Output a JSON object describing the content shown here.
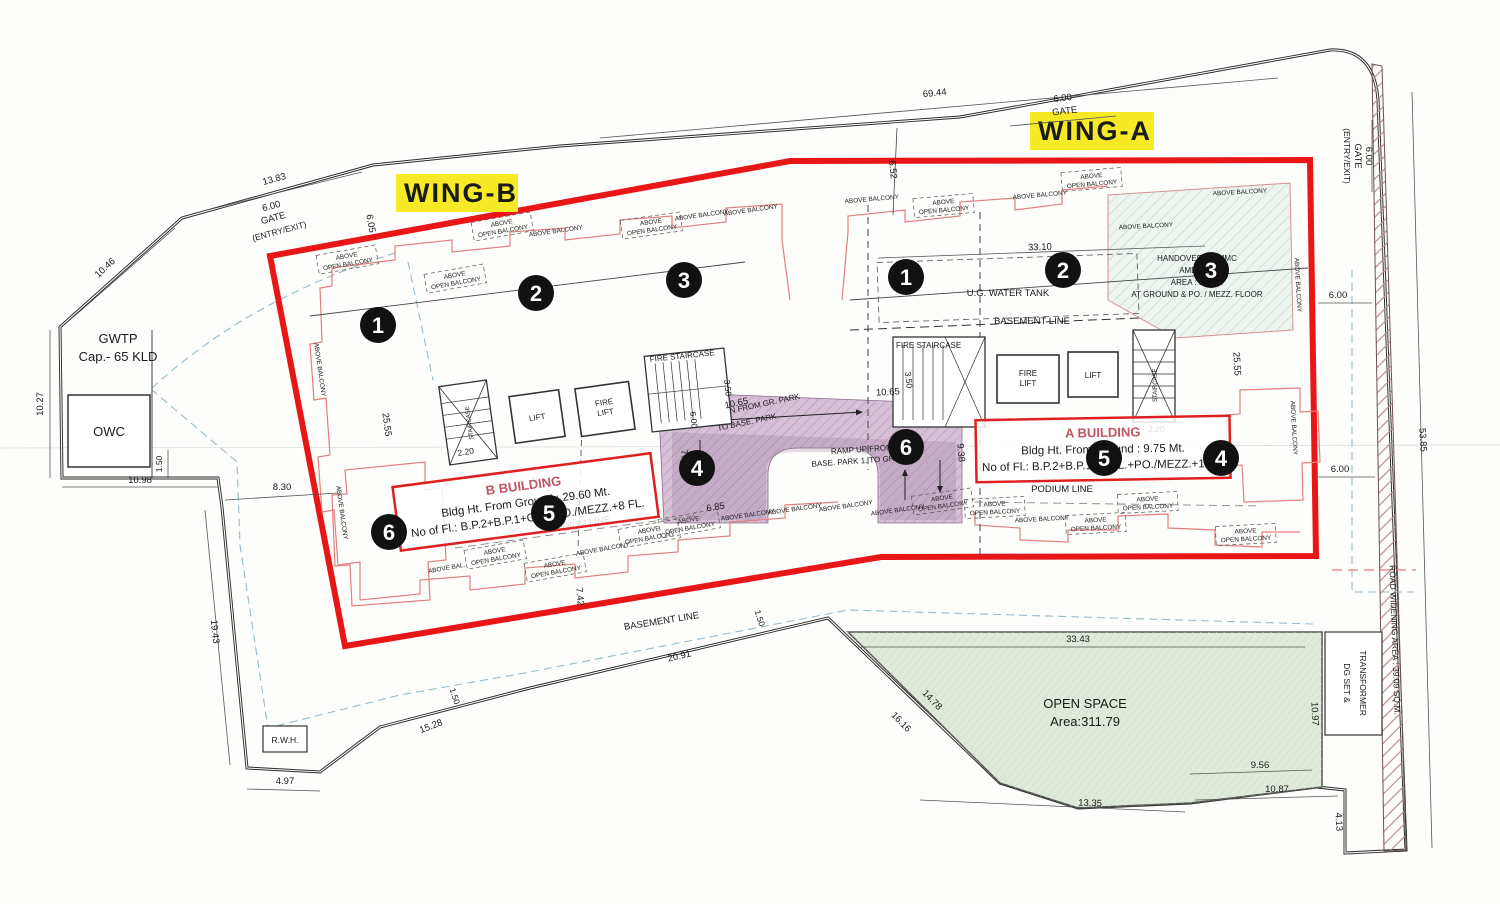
{
  "wings": {
    "a": "WING-A",
    "b": "WING-B"
  },
  "markers": {
    "m1": "1",
    "m2": "2",
    "m3": "3",
    "m4": "4",
    "m5": "5",
    "m6": "6"
  },
  "labels": {
    "above": "ABOVE",
    "open_balcony": "OPEN BALCONY",
    "above_balcony": "ABOVE BALCONY",
    "above_bal": "ABOVE BAL.",
    "podium_line": "PODIUM LINE",
    "basement_line": "BASEMENT LINE",
    "fire_staircase": "FIRE STAIRCASE",
    "staircase": "STAIRCASE",
    "lift": "LIFT",
    "fire": "FIRE",
    "ug_water_tank": "U.G. WATER TANK",
    "gwtp_1": "GWTP",
    "gwtp_2": "Cap.- 65 KLD",
    "owc": "OWC",
    "rwh": "R.W.H.",
    "open_space_1": "OPEN SPACE",
    "open_space_2": "Area:311.79",
    "dg_set_1": "DG SET &",
    "dg_set_2": "TRANSFORMER",
    "road_widening": "ROAD WIDENING AREA : 39.09 SQ.M.",
    "handover_1": "HANDOVER TO MMC",
    "handover_2": "AMENITY",
    "handover_3": "AREA : 182.86",
    "handover_4": "AT GROUND & PO. / MEZZ. FLOOR",
    "ramp_dn_1": "RAMP DN FROM GR. PARK",
    "ramp_dn_2": "TO BASE. PARK",
    "ramp_up_1": "RAMP UP FROM",
    "ramp_up_2": "BASE. PARK 1. TO GR. PARK",
    "gate": "GATE",
    "entry_exit": "(ENTRY/EXIT)"
  },
  "buildings": {
    "a": {
      "title": "A BUILDING",
      "ht": "Bldg Ht. From Ground : 9.75 Mt.",
      "fl": "No of Fl.: B.P.2+B.P.1+G.FL.+PO./MEZZ.+1 FL."
    },
    "b": {
      "title": "B BUILDING",
      "ht": "Bldg Ht. From Ground : 29.60 Mt.",
      "fl": "No of Fl.: B.P.2+B.P.1+G.P.+PO./MEZZ.+8 FL."
    }
  },
  "dims": {
    "d13_83": "13.83",
    "d6_00": "6.00",
    "d10_46": "10.46",
    "d10_27": "10.27",
    "d69_44": "69.44",
    "d6_52": "6.52",
    "d6_05": "6.05",
    "d53_85": "53.85",
    "d10_98": "10.98",
    "d1_50": "1.50",
    "d8_30": "8.30",
    "d19_43": "19.43",
    "d4_97": "4.97",
    "d15_28": "15.28",
    "d20_91": "20.91",
    "d7_42": "7.42",
    "d33_43": "33.43",
    "d14_78": "14.78",
    "d16_16": "16.16",
    "d13_35": "13.35",
    "d9_56": "9.56",
    "d10_87": "10.87",
    "d10_97": "10.97",
    "d4_13": "4.13",
    "d33_10": "33.10",
    "d25_55": "25.55",
    "d3_50": "3.50",
    "d2_20": "2.20",
    "d10_65": "10.65",
    "d7_70": "7.70",
    "d6_85": "6.85",
    "d9_38": "9.38"
  },
  "colors": {
    "boundary_red": "#e81616",
    "building_red": "#e37f7f",
    "highlight_yellow": "#f6e926",
    "basement_blue": "#93bcd0",
    "open_space_green": "#dfeadb",
    "ramp_purple": "#d5c0d5",
    "hatch_green": "#9dc4b0",
    "road_hatch": "#b98f8f"
  }
}
